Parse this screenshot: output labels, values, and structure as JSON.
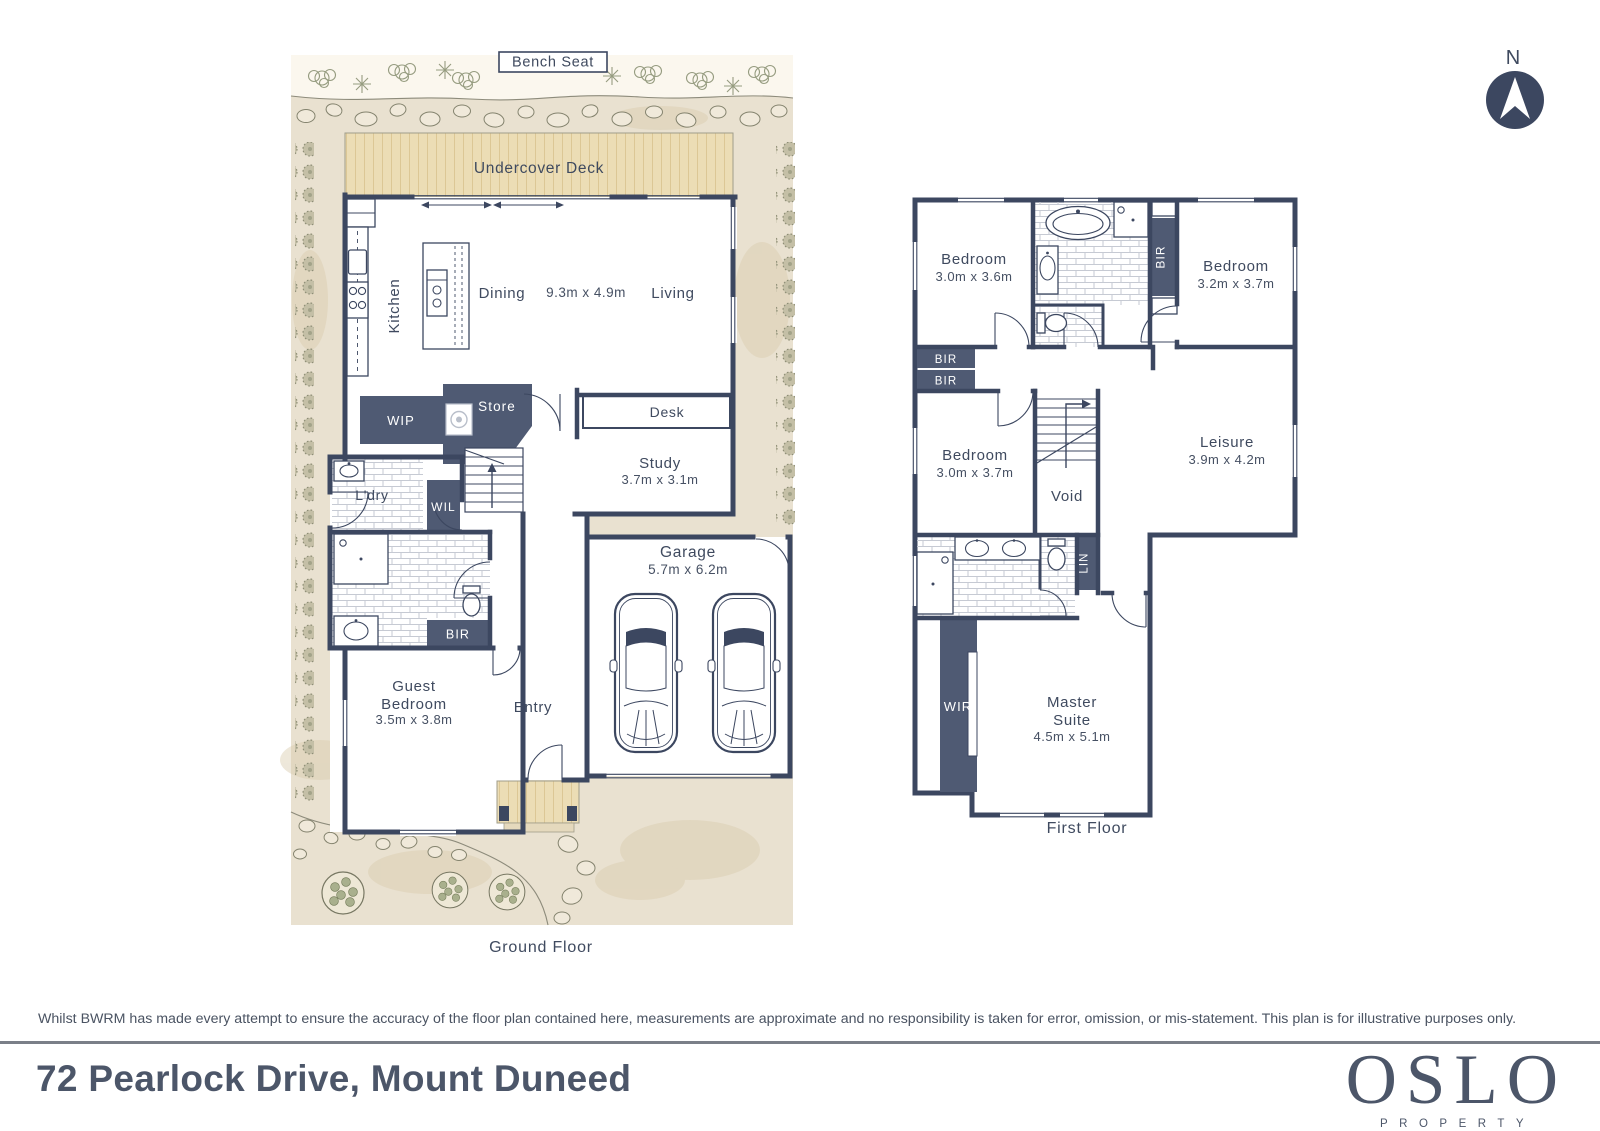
{
  "page": {
    "compass_label": "N",
    "disclaimer": "Whilst BWRM  has made every attempt to ensure the accuracy of the floor plan contained here, measurements are approximate and no responsibility is taken for error, omission, or mis-statement. This plan is for illustrative purposes only.",
    "address": "72 Pearlock Drive, Mount Duneed",
    "brand": {
      "name": "OSLO",
      "tagline": "PROPERTY"
    }
  },
  "ground_floor": {
    "caption": "Ground Floor",
    "bench_seat": "Bench Seat",
    "deck": "Undercover Deck",
    "kitchen": "Kitchen",
    "dining": "Dining",
    "living": "Living",
    "living_dims": "9.3m x 4.9m",
    "wip": "WIP",
    "store": "Store",
    "desk": "Desk",
    "study": "Study",
    "study_dims": "3.7m x 3.1m",
    "laundry": "L'dry",
    "wil": "WIL",
    "bir": "BIR",
    "guest_line1": "Guest",
    "guest_line2": "Bedroom",
    "guest_dims": "3.5m x 3.8m",
    "entry": "Entry",
    "garage": "Garage",
    "garage_dims": "5.7m x 6.2m"
  },
  "first_floor": {
    "caption": "First Floor",
    "bedroom2": "Bedroom",
    "bedroom2_dims": "3.0m x 3.6m",
    "bedroom3": "Bedroom",
    "bedroom3_dims": "3.2m x 3.7m",
    "bedroom4": "Bedroom",
    "bedroom4_dims": "3.0m x 3.7m",
    "leisure": "Leisure",
    "leisure_dims": "3.9m x 4.2m",
    "void": "Void",
    "lin": "LIN",
    "wir": "WIR",
    "bir": "BIR",
    "master_line1": "Master",
    "master_line2": "Suite",
    "master_dims": "4.5m x 5.1m"
  }
}
